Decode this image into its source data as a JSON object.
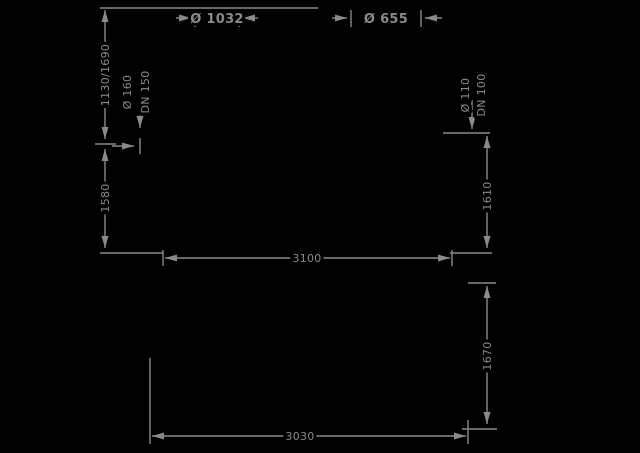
{
  "page": {
    "background_color": "#000000",
    "line_color": "#8a8a8a"
  },
  "top_dimensions": {
    "left_tank_diameter": "Ø 1032",
    "right_tank_diameter": "Ø 655"
  },
  "left_tank": {
    "upper_height": "1130/1690",
    "lower_height": "1580",
    "connection_diameter": "Ø 160",
    "connection_dn": "DN 150"
  },
  "right_tank": {
    "connection_diameter": "Ø 110",
    "connection_dn": "DN 100",
    "upper_height": "1610",
    "lower_height": "1670"
  },
  "spans": {
    "center_distance": "3100",
    "overall_width": "3030"
  }
}
